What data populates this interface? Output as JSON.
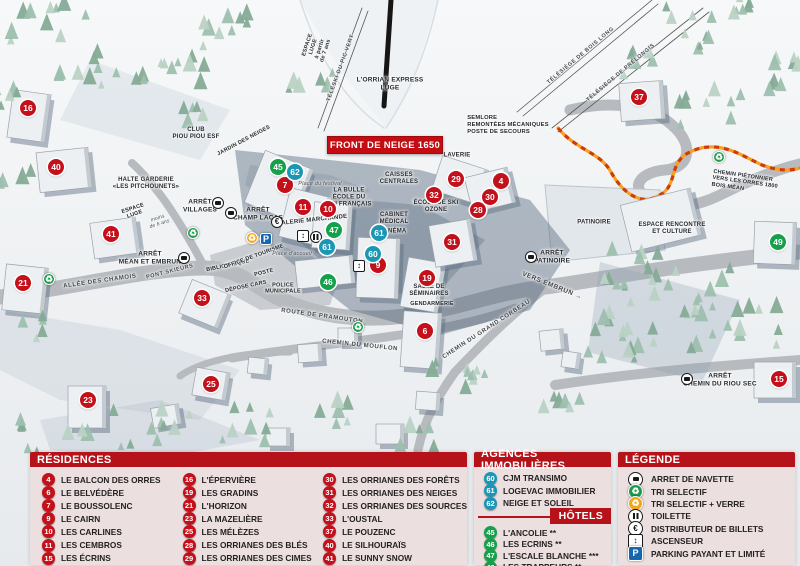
{
  "map": {
    "banner": "FRONT DE NEIGE 1650",
    "marker_colors": {
      "residence": "#c3101b",
      "hotel": "#17a04c",
      "agency": "#1b96b5"
    },
    "markers": [
      {
        "n": "16",
        "t": "res",
        "x": 28,
        "y": 108
      },
      {
        "n": "40",
        "t": "res",
        "x": 56,
        "y": 167
      },
      {
        "n": "41",
        "t": "res",
        "x": 111,
        "y": 234
      },
      {
        "n": "21",
        "t": "res",
        "x": 23,
        "y": 283
      },
      {
        "n": "33",
        "t": "res",
        "x": 202,
        "y": 298
      },
      {
        "n": "25",
        "t": "res",
        "x": 211,
        "y": 384
      },
      {
        "n": "23",
        "t": "res",
        "x": 88,
        "y": 400
      },
      {
        "n": "7",
        "t": "res",
        "x": 285,
        "y": 185
      },
      {
        "n": "11",
        "t": "res",
        "x": 303,
        "y": 207
      },
      {
        "n": "10",
        "t": "res",
        "x": 328,
        "y": 209
      },
      {
        "n": "9",
        "t": "res",
        "x": 378,
        "y": 265
      },
      {
        "n": "19",
        "t": "res",
        "x": 427,
        "y": 278
      },
      {
        "n": "6",
        "t": "res",
        "x": 425,
        "y": 331
      },
      {
        "n": "29",
        "t": "res",
        "x": 456,
        "y": 179
      },
      {
        "n": "4",
        "t": "res",
        "x": 501,
        "y": 181
      },
      {
        "n": "32",
        "t": "res",
        "x": 434,
        "y": 195
      },
      {
        "n": "30",
        "t": "res",
        "x": 490,
        "y": 197
      },
      {
        "n": "28",
        "t": "res",
        "x": 478,
        "y": 210
      },
      {
        "n": "31",
        "t": "res",
        "x": 452,
        "y": 242
      },
      {
        "n": "37",
        "t": "res",
        "x": 639,
        "y": 97
      },
      {
        "n": "15",
        "t": "res",
        "x": 779,
        "y": 379
      },
      {
        "n": "45",
        "t": "hot",
        "x": 278,
        "y": 167
      },
      {
        "n": "47",
        "t": "hot",
        "x": 334,
        "y": 230
      },
      {
        "n": "46",
        "t": "hot",
        "x": 328,
        "y": 282
      },
      {
        "n": "49",
        "t": "hot",
        "x": 778,
        "y": 242
      },
      {
        "n": "62",
        "t": "ag",
        "x": 295,
        "y": 172
      },
      {
        "n": "61",
        "t": "ag",
        "x": 379,
        "y": 233
      },
      {
        "n": "61",
        "t": "ag",
        "x": 327,
        "y": 247
      },
      {
        "n": "60",
        "t": "ag",
        "x": 373,
        "y": 254
      }
    ],
    "labels": [
      {
        "t": "L'ORRIAN EXPRESS\nLUGE",
        "x": 390,
        "y": 84,
        "s": 6.5
      },
      {
        "t": "ESPACE\nLUGE\nà partir\nde 7 ans",
        "x": 317,
        "y": 48,
        "r": -72,
        "s": 5.5
      },
      {
        "t": "TÉLÉSKI DU PIC VERT",
        "x": 341,
        "y": 68,
        "r": -70,
        "s": 5.5,
        "c": "road"
      },
      {
        "t": "TÉLÉSIÈGE DE BOIS LONG",
        "x": 581,
        "y": 56,
        "r": -40,
        "s": 5.5,
        "c": "road"
      },
      {
        "t": "TÉLÉSIÈGE DE PRÉLONGIS",
        "x": 621,
        "y": 73,
        "r": -40,
        "s": 5.5,
        "c": "road"
      },
      {
        "t": "SEMLORE\nREMONTÉES MÉCANIQUES\nPOSTE DE SECOURS",
        "x": 508,
        "y": 125,
        "s": 5.8,
        "c": "left"
      },
      {
        "t": "CLUB\nPIOU PIOU ESF",
        "x": 196,
        "y": 134,
        "s": 6
      },
      {
        "t": "JARDIN DES NEIGES",
        "x": 244,
        "y": 141,
        "r": -28,
        "s": 5.5
      },
      {
        "t": "HALTE GARDERIE\n«LES PITCHOUNETS»",
        "x": 146,
        "y": 184,
        "s": 6
      },
      {
        "t": "ESPACE\nLUGE",
        "x": 134,
        "y": 212,
        "r": -18,
        "s": 5.5
      },
      {
        "t": "moins\nde 6 ans",
        "x": 159,
        "y": 222,
        "r": -18,
        "s": 5,
        "c": "place"
      },
      {
        "t": "ARRÊT\nVILLAGES",
        "x": 200,
        "y": 206,
        "s": 6.5
      },
      {
        "t": "ARRÊT\nCHAMP LACAS",
        "x": 258,
        "y": 214,
        "s": 6.5
      },
      {
        "t": "ARRÊT\nMÉAN ET EMBRUN",
        "x": 150,
        "y": 258,
        "s": 6.5
      },
      {
        "t": "ALLÉE DES CHAMOIS",
        "x": 100,
        "y": 282,
        "r": -8,
        "s": 6,
        "c": "road"
      },
      {
        "t": "PONT SKIEURS",
        "x": 170,
        "y": 272,
        "r": -14,
        "s": 5.5,
        "c": "road"
      },
      {
        "t": "BIBLIOTHÈQUE",
        "x": 228,
        "y": 266,
        "r": -12,
        "s": 5.5
      },
      {
        "t": "OFFICE DE TOURISME",
        "x": 254,
        "y": 257,
        "r": -20,
        "s": 5.5
      },
      {
        "t": "POSTE",
        "x": 264,
        "y": 273,
        "r": -14,
        "s": 5.5
      },
      {
        "t": "DÉPOSE CARS",
        "x": 246,
        "y": 287,
        "r": -12,
        "s": 5.5
      },
      {
        "t": "POLICE\nMUNICIPALE",
        "x": 283,
        "y": 289,
        "s": 5.5
      },
      {
        "t": "Place d'accueil",
        "x": 292,
        "y": 254,
        "s": 5.5,
        "c": "place"
      },
      {
        "t": "Place du festival",
        "x": 320,
        "y": 184,
        "s": 5.5,
        "c": "place"
      },
      {
        "t": "GALERIE MARCHANDE",
        "x": 312,
        "y": 221,
        "r": -6,
        "s": 6
      },
      {
        "t": "LA BULLE\nÉCOLE DU\nSKI FRANÇAIS",
        "x": 349,
        "y": 198,
        "s": 6
      },
      {
        "t": "CAISSES\nCENTRALES",
        "x": 399,
        "y": 179,
        "s": 6
      },
      {
        "t": "CABINET\nMÉDICAL",
        "x": 394,
        "y": 219,
        "s": 6
      },
      {
        "t": "CINÉMA",
        "x": 394,
        "y": 232,
        "s": 6
      },
      {
        "t": "LAVERIE",
        "x": 457,
        "y": 156,
        "s": 6
      },
      {
        "t": "ÉCOLE DE SKI\nOZONE",
        "x": 436,
        "y": 207,
        "s": 6
      },
      {
        "t": "SALLE DE\nSÉMINAIRES",
        "x": 429,
        "y": 291,
        "s": 6
      },
      {
        "t": "GENDARMERIE",
        "x": 432,
        "y": 304,
        "s": 5.5
      },
      {
        "t": "ROUTE DE PRAMOUTON",
        "x": 322,
        "y": 317,
        "r": 8,
        "s": 6,
        "c": "road"
      },
      {
        "t": "CHEMIN DU MOUFLON",
        "x": 360,
        "y": 346,
        "r": 6,
        "s": 6,
        "c": "road"
      },
      {
        "t": "CHEMIN DU GRAND CORBEAU",
        "x": 487,
        "y": 330,
        "r": -33,
        "s": 6,
        "c": "road"
      },
      {
        "t": "VERS EMBRUN →",
        "x": 552,
        "y": 286,
        "r": 22,
        "s": 6.5,
        "c": "road"
      },
      {
        "t": "ARRÊT\nPATINOIRE",
        "x": 552,
        "y": 257,
        "s": 6.5
      },
      {
        "t": "PATINOIRE",
        "x": 594,
        "y": 223,
        "s": 6
      },
      {
        "t": "ESPACE RENCONTRE\nET CULTURE",
        "x": 672,
        "y": 229,
        "s": 6
      },
      {
        "t": "CHEMIN PIÉTONNIER\nVERS LES ORRES 1800\nBOIS MÉAN",
        "x": 745,
        "y": 183,
        "r": 8,
        "s": 5.5,
        "c": "left"
      },
      {
        "t": "ARRÊT\nCHEMIN DU RIOU SEC",
        "x": 720,
        "y": 380,
        "s": 6.5
      }
    ],
    "icons": [
      {
        "k": "bus",
        "x": 218,
        "y": 203
      },
      {
        "k": "bus",
        "x": 231,
        "y": 213
      },
      {
        "k": "bus",
        "x": 184,
        "y": 258
      },
      {
        "k": "bus",
        "x": 531,
        "y": 257
      },
      {
        "k": "bus",
        "x": 687,
        "y": 379
      },
      {
        "k": "rec-g",
        "x": 193,
        "y": 233
      },
      {
        "k": "rec-g",
        "x": 49,
        "y": 279
      },
      {
        "k": "rec-g",
        "x": 358,
        "y": 327
      },
      {
        "k": "rec-g",
        "x": 719,
        "y": 157
      },
      {
        "k": "rec-o",
        "x": 252,
        "y": 238
      },
      {
        "k": "park",
        "x": 266,
        "y": 239
      },
      {
        "k": "euro",
        "x": 277,
        "y": 222
      },
      {
        "k": "lift",
        "x": 303,
        "y": 236
      },
      {
        "k": "wc",
        "x": 316,
        "y": 237
      },
      {
        "k": "lift",
        "x": 359,
        "y": 266
      }
    ]
  },
  "legend": {
    "residences": {
      "title": "RÉSIDENCES",
      "columns": [
        [
          {
            "n": "4",
            "label": "LE BALCON DES ORRES"
          },
          {
            "n": "6",
            "label": "LE BELVÉDÈRE"
          },
          {
            "n": "7",
            "label": "LE BOUSSOLENC"
          },
          {
            "n": "9",
            "label": "LE CAIRN"
          },
          {
            "n": "10",
            "label": "LES CARLINES"
          },
          {
            "n": "11",
            "label": "LES CEMBROS"
          },
          {
            "n": "15",
            "label": "LES ÉCRINS"
          }
        ],
        [
          {
            "n": "16",
            "label": "L'ÉPERVIÈRE"
          },
          {
            "n": "19",
            "label": "LES GRADINS"
          },
          {
            "n": "21",
            "label": "L'HORIZON"
          },
          {
            "n": "23",
            "label": "LA MAZELIÈRE"
          },
          {
            "n": "25",
            "label": "LES MÉLÈZES"
          },
          {
            "n": "28",
            "label": "LES ORRIANES DES BLÉS"
          },
          {
            "n": "29",
            "label": "LES ORRIANES DES CIMES"
          }
        ],
        [
          {
            "n": "30",
            "label": "LES ORRIANES DES FORÊTS"
          },
          {
            "n": "31",
            "label": "LES ORRIANES DES NEIGES"
          },
          {
            "n": "32",
            "label": "LES ORRIANES DES SOURCES"
          },
          {
            "n": "33",
            "label": "L'OUSTAL"
          },
          {
            "n": "37",
            "label": "LE POUZENC"
          },
          {
            "n": "40",
            "label": "LE SILHOURAÏS"
          },
          {
            "n": "41",
            "label": "LE SUNNY SNOW"
          }
        ]
      ]
    },
    "agences": {
      "title": "AGENCES IMMOBILIÈRES",
      "items": [
        {
          "n": "60",
          "label": "CJM TRANSIMO"
        },
        {
          "n": "61",
          "label": "LOGEVAC IMMOBILIER"
        },
        {
          "n": "62",
          "label": "NEIGE ET SOLEIL"
        }
      ]
    },
    "hotels": {
      "title": "HÔTELS",
      "items": [
        {
          "n": "45",
          "label": "L'ANCOLIE **"
        },
        {
          "n": "46",
          "label": "LES ECRINS **"
        },
        {
          "n": "47",
          "label": "L'ESCALE BLANCHE ***"
        },
        {
          "n": "49",
          "label": "LES TRAPPEURS **"
        }
      ]
    },
    "legende": {
      "title": "LÉGENDE",
      "items": [
        {
          "icon": "bus",
          "label": "ARRET DE NAVETTE"
        },
        {
          "icon": "rec-g",
          "label": "TRI SELECTIF"
        },
        {
          "icon": "rec-o",
          "label": "TRI SELECTIF + VERRE"
        },
        {
          "icon": "wc",
          "label": "TOILETTE"
        },
        {
          "icon": "euro",
          "label": "DISTRIBUTEUR DE BILLETS"
        },
        {
          "icon": "lift",
          "label": "ASCENSEUR"
        },
        {
          "icon": "park",
          "label": "PARKING PAYANT ET LIMITÉ"
        }
      ]
    }
  }
}
